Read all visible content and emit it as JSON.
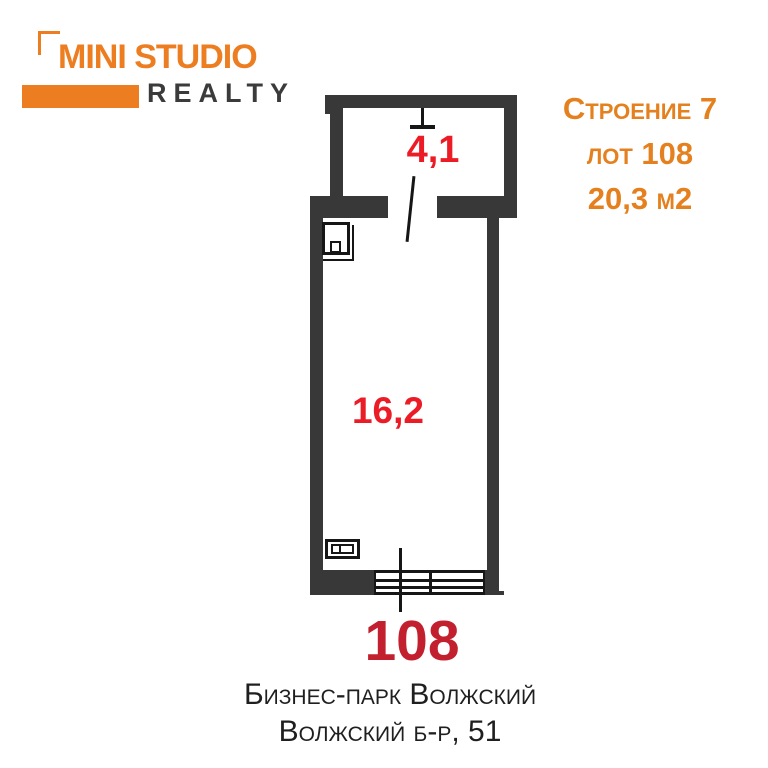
{
  "colors": {
    "accent_orange": "#ED7D21",
    "listing_orange": "#E5801F",
    "room_label_red": "#EC1C26",
    "lot_number_red": "#C2202E",
    "wall_gray": "#383838",
    "logo_text_dark": "#3B3B3C",
    "address_text": "#1F1F1F"
  },
  "logo": {
    "title": "MINI STUDIO",
    "subtitle": "REALTY"
  },
  "listing": {
    "building": "Строение 7",
    "lot": "лот 108",
    "area": "20,3 м2"
  },
  "plan": {
    "rooms": [
      {
        "id": "room-upper",
        "area_label": "4,1"
      },
      {
        "id": "room-main",
        "area_label": "16,2"
      }
    ]
  },
  "footer": {
    "lot_number": "108",
    "address_line1": "Бизнес-парк Волжский",
    "address_line2": "Волжский б-р, 51"
  }
}
